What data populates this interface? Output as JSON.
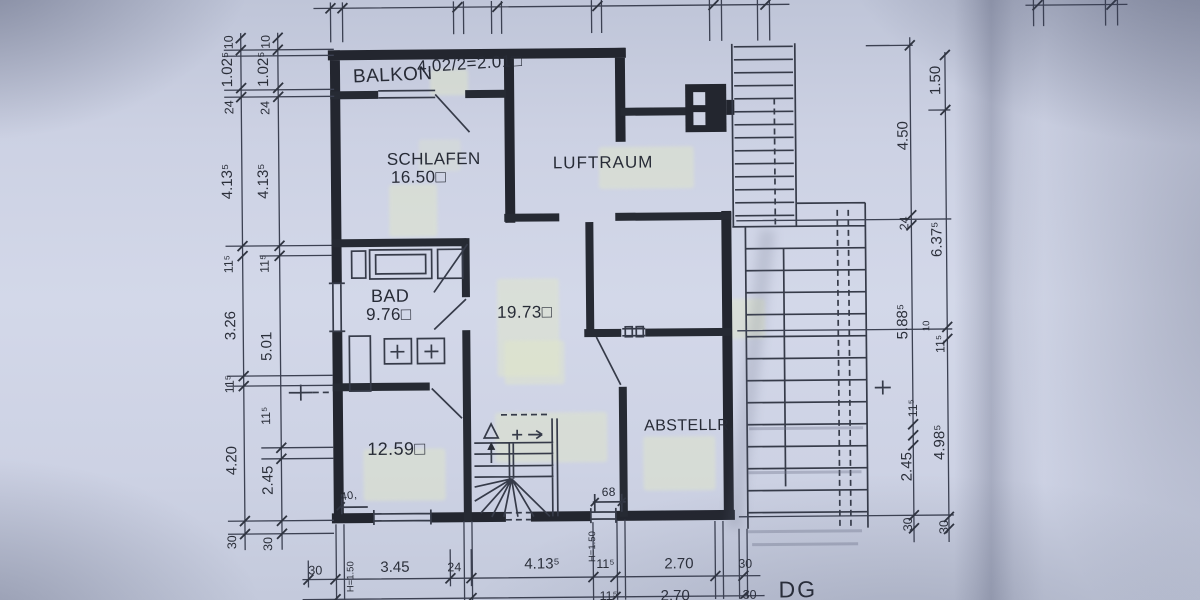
{
  "drawing": {
    "floor_label": "DG",
    "rooms": {
      "balkon": "BALKON",
      "schlafen": "SCHLAFEN",
      "schlafen_area": "16.50□",
      "luftraum": "LUFTRAUM",
      "bad": "BAD",
      "bad_area": "9.76□",
      "zimmer_area": "19.73□",
      "zimmer2_area": "12.59□",
      "abstellraum": "ABSTELLR."
    },
    "annotations": {
      "balkon_calc": "4.02/2=2.01□",
      "door_height_1": "H=1.50",
      "door_height_2": "H=1.50",
      "small_dim_40": "40,",
      "small_dim_68": "68"
    },
    "dims": {
      "left_outer": [
        "10",
        "1.02⁵",
        "24",
        "4.13⁵",
        "11⁵",
        "3.26",
        "11⁵",
        "4.20",
        "30"
      ],
      "left_inner": [
        "10",
        "1.02⁵",
        "24",
        "4.13⁵",
        "11⁵",
        "5.01",
        "11⁵",
        "2.45",
        "30"
      ],
      "right_inner": [
        "4.50",
        "24",
        "5.88⁵",
        "10",
        "11⁵",
        "2.45",
        "30"
      ],
      "right_outer": [
        "1.50",
        "6.37⁵",
        "11⁵",
        "4.98⁵",
        "30"
      ],
      "bottom_row1": [
        "30",
        "3.45",
        "24",
        "4.13⁵",
        "11⁵",
        "2.70",
        "30"
      ],
      "bottom_row2": [
        "11⁵",
        "2.70",
        "30"
      ]
    }
  }
}
